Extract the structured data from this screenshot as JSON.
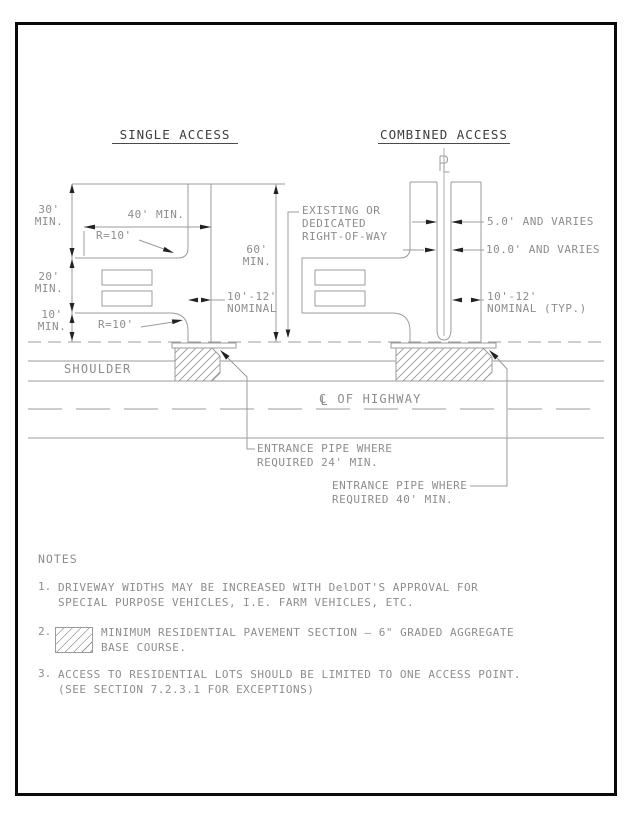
{
  "page_title": "RESIDENTIAL DRIVEWAY ACCESS DETAIL",
  "colors": {
    "border": "#0a0a0a",
    "line": "#9b9b9b",
    "text": "#8d8d8d",
    "title": "#3d3d3d",
    "arrow": "#222222"
  },
  "titles": {
    "single": "SINGLE ACCESS",
    "combined": "COMBINED ACCESS"
  },
  "single_access": {
    "v30_a": "30'",
    "v30_b": "MIN.",
    "v20_a": "20'",
    "v20_b": "MIN.",
    "v10_a": "10'",
    "v10_b": "MIN.",
    "h40": "40' MIN.",
    "r10_top": "R=10'",
    "r10_bottom": "R=10'",
    "v60_a": "60'",
    "v60_b": "MIN.",
    "nominal_a": "10'-12'",
    "nominal_b": "NOMINAL"
  },
  "combined_access": {
    "varies_5": "5.0' AND VARIES",
    "varies_10": "10.0' AND VARIES",
    "nominal_a": "10'-12'",
    "nominal_b": "NOMINAL (TYP.)"
  },
  "right_of_way_label": {
    "l1": "EXISTING OR",
    "l2": "DEDICATED",
    "l3": "RIGHT-OF-WAY"
  },
  "highway": {
    "shoulder": "SHOULDER",
    "cl_c": "C",
    "cl_l": "L",
    "cl_text": "OF HIGHWAY",
    "pipe24_l1": "ENTRANCE PIPE WHERE",
    "pipe24_l2": "REQUIRED 24' MIN.",
    "pipe40_l1": "ENTRANCE PIPE WHERE",
    "pipe40_l2": "REQUIRED 40' MIN."
  },
  "notes": {
    "header": "NOTES",
    "items": [
      {
        "num": "1.",
        "l1": "DRIVEWAY WIDTHS MAY BE INCREASED WITH DelDOT'S APPROVAL FOR",
        "l2": "SPECIAL PURPOSE VEHICLES, I.E. FARM VEHICLES, ETC."
      },
      {
        "num": "2.",
        "l1": "MINIMUM RESIDENTIAL PAVEMENT SECTION — 6\" GRADED AGGREGATE",
        "l2": "BASE COURSE."
      },
      {
        "num": "3.",
        "l1": "ACCESS TO RESIDENTIAL LOTS SHOULD BE LIMITED TO ONE ACCESS POINT.",
        "l2": "(SEE SECTION 7.2.3.1 FOR EXCEPTIONS)"
      }
    ]
  }
}
